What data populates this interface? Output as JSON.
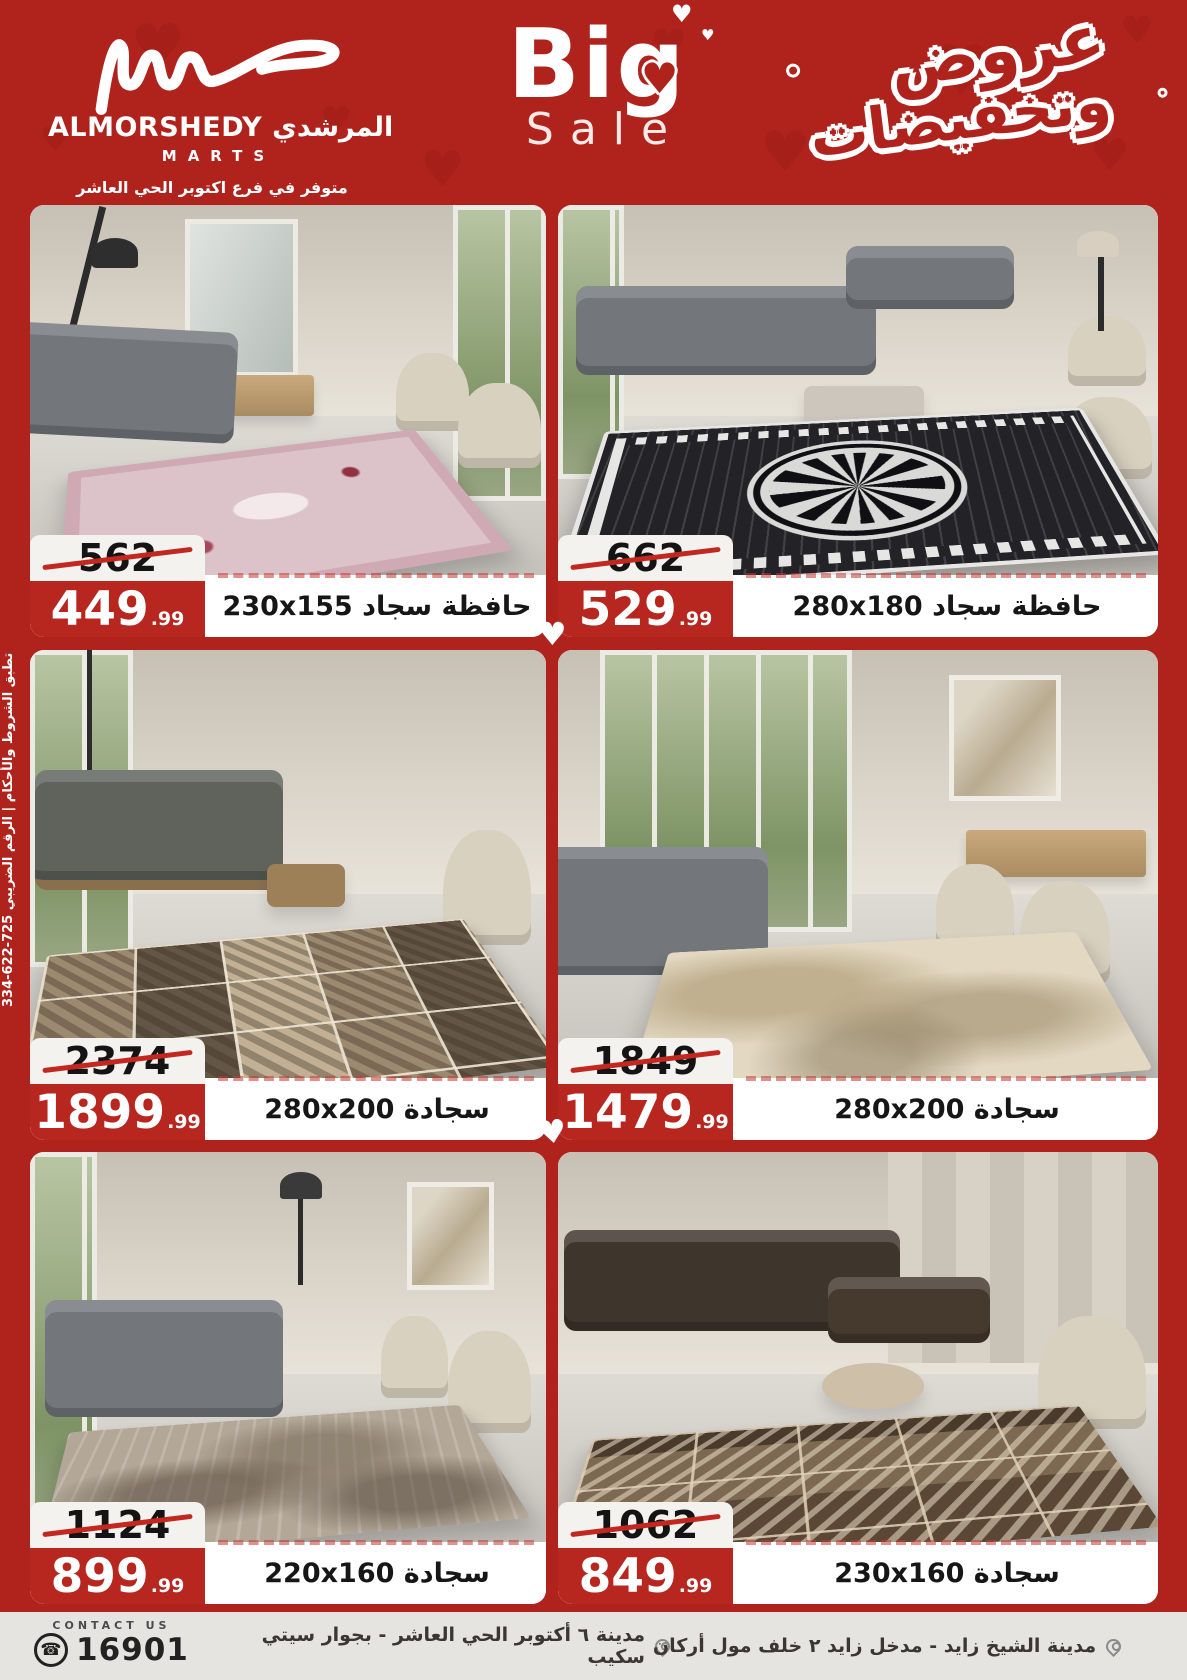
{
  "header": {
    "brand": {
      "name_en": "ALMORSHEDY",
      "name_ar": "المرشدي",
      "subtitle": "MARTS",
      "branch_note": "متوفر في فرع اكتوبر الحي العاشر"
    },
    "big_sale": {
      "word1": "Big",
      "word2": "Sale"
    },
    "offers_banner": {
      "line1": "عروض",
      "line2": "وتخفيضات"
    }
  },
  "side_note": "تطبق الشروط والأحكام | الرقم الضريبي 725-622-334",
  "products": [
    {
      "label": "حافظة سجاد 230x155",
      "old_price": "562",
      "price": "449",
      "cents": ".99"
    },
    {
      "label": "حافظة سجاد 280x180",
      "old_price": "662",
      "price": "529",
      "cents": ".99"
    },
    {
      "label": "سجادة 280x200",
      "old_price": "2374",
      "price": "1899",
      "cents": ".99"
    },
    {
      "label": "سجادة 280x200",
      "old_price": "1849",
      "price": "1479",
      "cents": ".99"
    },
    {
      "label": "سجادة 220x160",
      "old_price": "1124",
      "price": "899",
      "cents": ".99"
    },
    {
      "label": "سجادة 230x160",
      "old_price": "1062",
      "price": "849",
      "cents": ".99"
    }
  ],
  "footer": {
    "contact_label": "CONTACT US",
    "phone": "16901",
    "address_october": "مدينة ٦ أكتوبر الحي العاشر - بجوار سيتي سكيب",
    "address_zayed": "مدينة الشيخ زايد - مدخل زايد ٢ خلف مول أركان"
  },
  "colors": {
    "brand_red": "#b0231d",
    "price_red": "#b7261f",
    "strike_red": "#c2281f",
    "footer_bg": "#e6e4e1"
  },
  "icons": {
    "heart_glyph": "♥",
    "phone_glyph": "☎"
  }
}
